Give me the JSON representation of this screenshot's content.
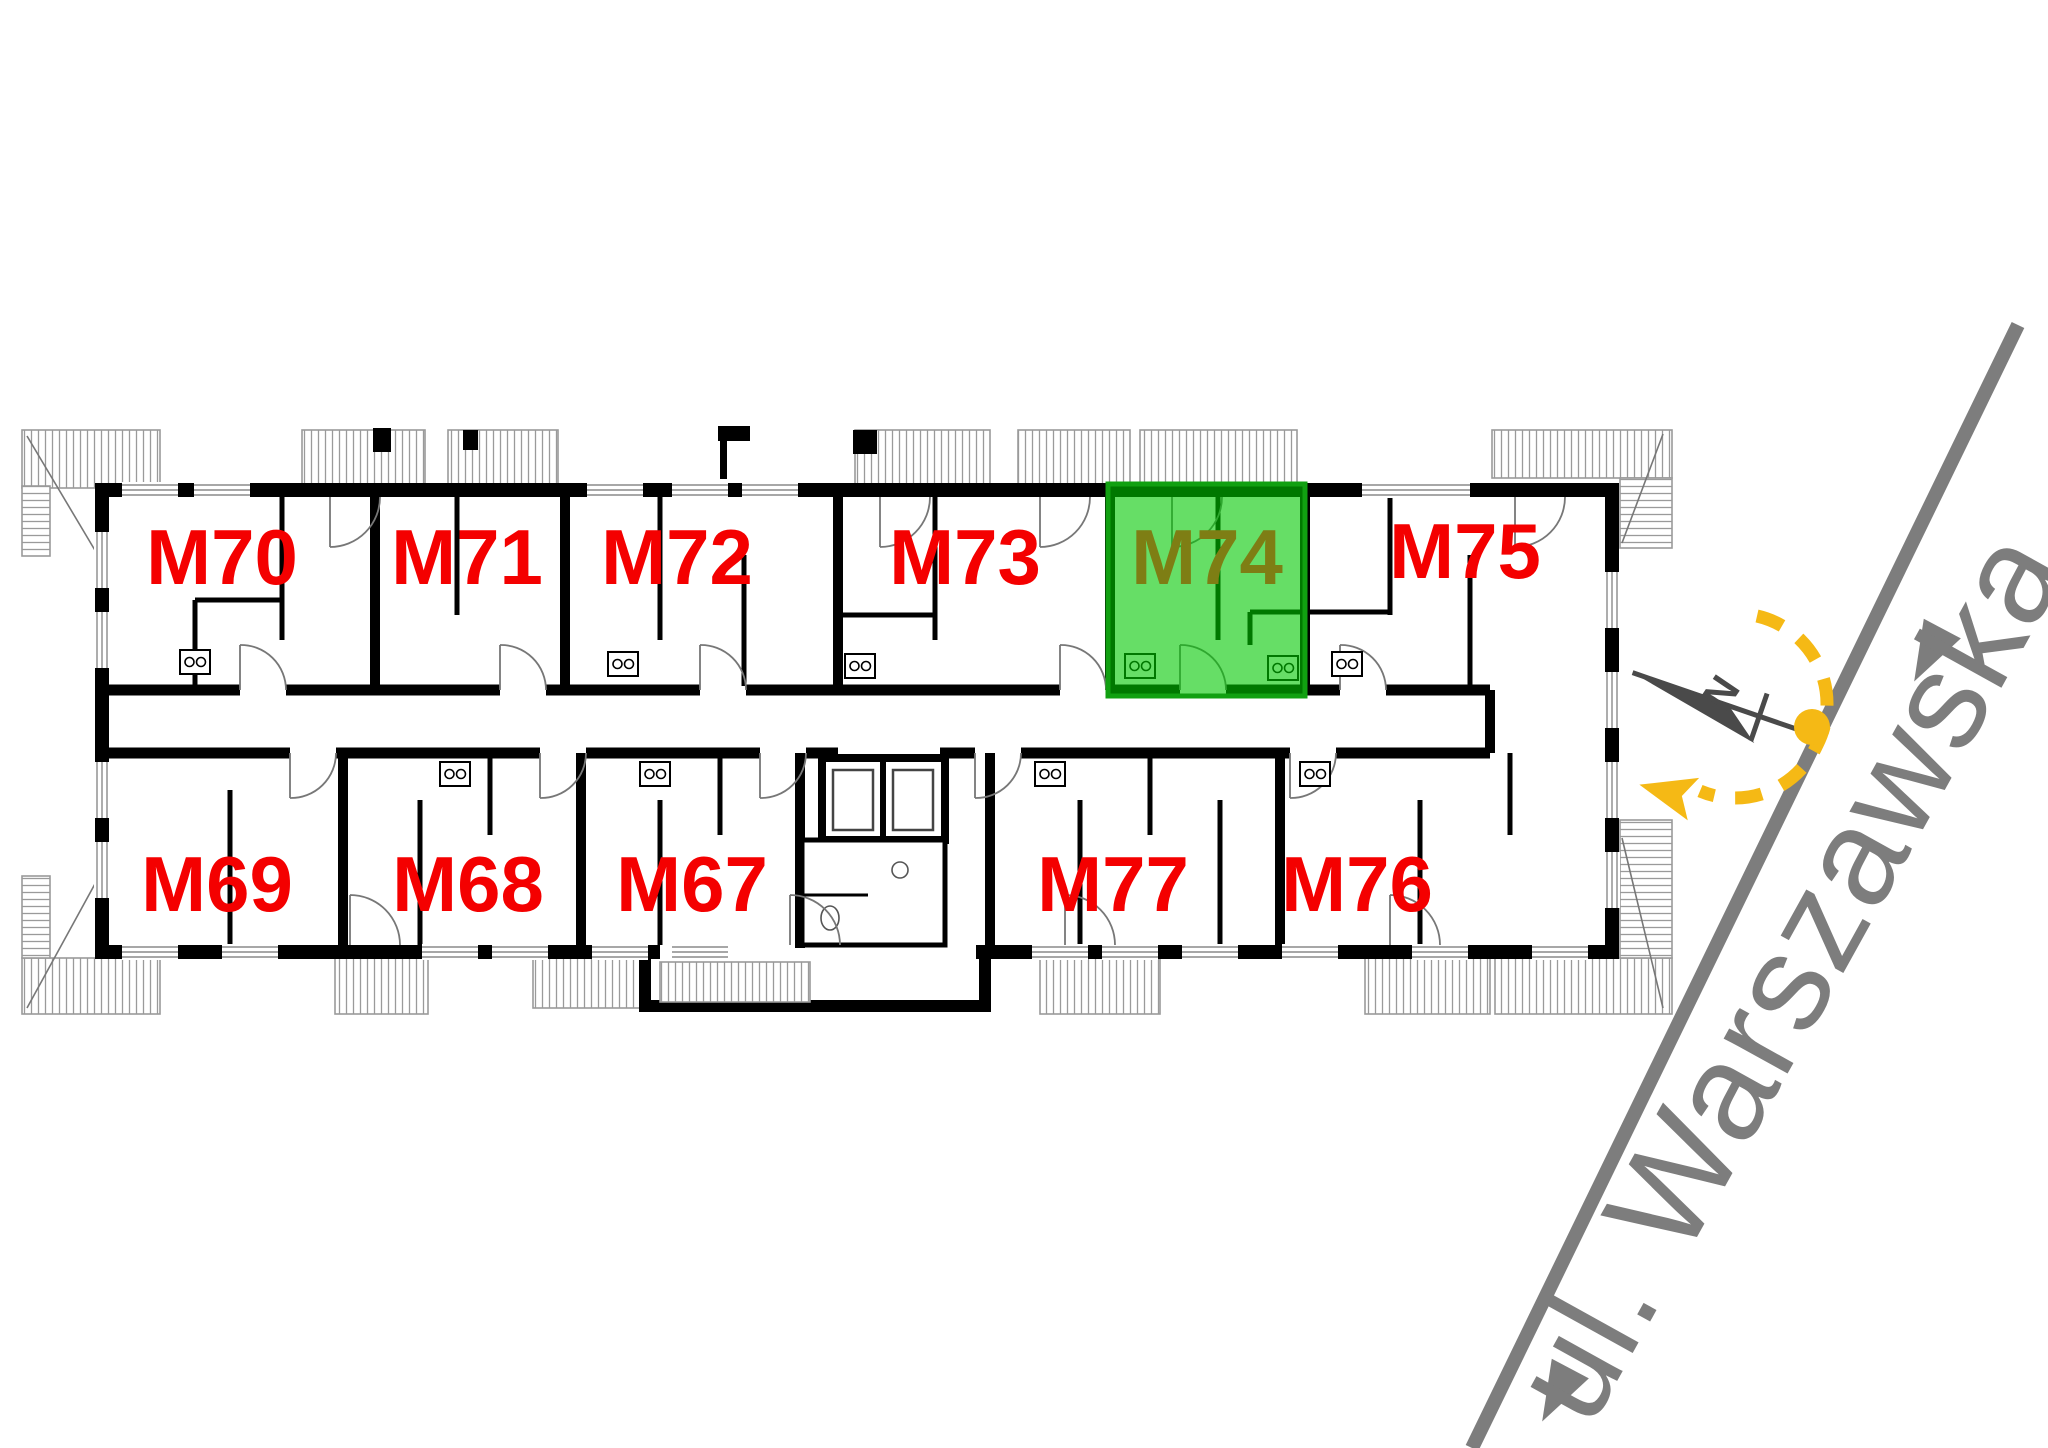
{
  "floor_plan": {
    "title_note": "apartment floor plan with highlighted unit",
    "units": [
      {
        "label": "M70",
        "row": "top",
        "highlighted": false
      },
      {
        "label": "M71",
        "row": "top",
        "highlighted": false
      },
      {
        "label": "M72",
        "row": "top",
        "highlighted": false
      },
      {
        "label": "M73",
        "row": "top",
        "highlighted": false
      },
      {
        "label": "M74",
        "row": "top",
        "highlighted": true
      },
      {
        "label": "M75",
        "row": "top",
        "highlighted": false
      },
      {
        "label": "M69",
        "row": "bottom",
        "highlighted": false
      },
      {
        "label": "M68",
        "row": "bottom",
        "highlighted": false
      },
      {
        "label": "M67",
        "row": "bottom",
        "highlighted": false
      },
      {
        "label": "M77",
        "row": "bottom",
        "highlighted": false
      },
      {
        "label": "M76",
        "row": "bottom",
        "highlighted": false
      }
    ],
    "highlighted_unit": "M74",
    "street": {
      "name": "ul. Warszawska"
    },
    "compass": {
      "north_label": "N"
    },
    "colors": {
      "unit_label": "#f40000",
      "highlight_fill": "#00c800",
      "highlight_border": "#11a011",
      "highlight_label": "#7e7e14",
      "street_gray": "#7d7d7d",
      "sun_yellow": "#f5b915",
      "compass_gray": "#4a4a4a",
      "wall_black": "#000000"
    }
  }
}
